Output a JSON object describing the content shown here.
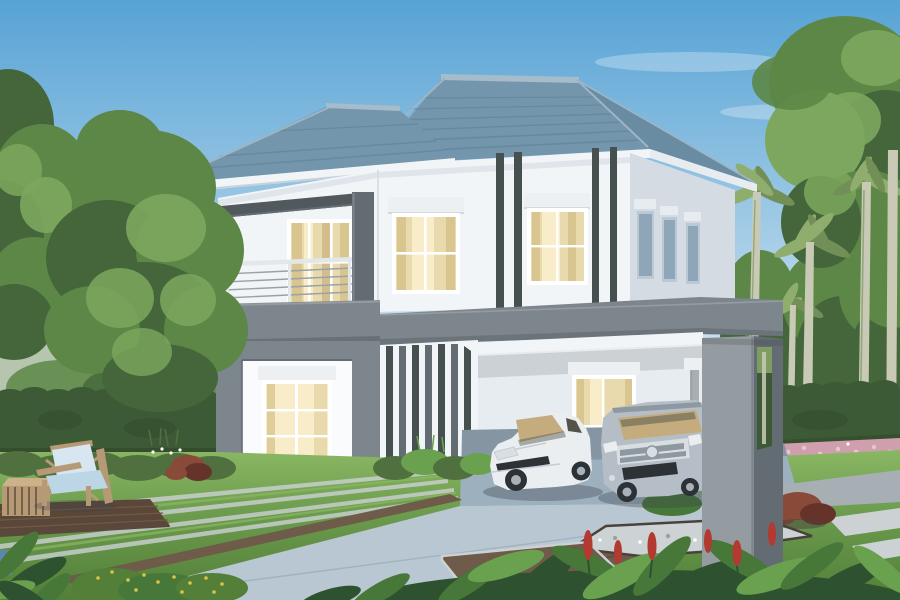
{
  "scene": {
    "type": "architectural exterior rendering",
    "description": "Modern two-storey detached house with slate-blue tiled hip roof, white walls with dark grey accent bands and charcoal pin-stripes, first-floor balcony with steel railing, warm-lit curtained windows, grey portal-frame carport sheltering a white sedan and a silver SUV, clipped hedges, palm trees, striped lawn, blue-grey paver driveway, timber deck with blue-cushioned armchair, white gravel bed and red-leaf shrubs",
    "objects": [
      "house",
      "hip-roof",
      "balcony",
      "carport",
      "white-sedan",
      "silver-suv",
      "outdoor-chair",
      "side-table",
      "timber-deck",
      "hedge-walls",
      "palm-trees",
      "garden-trees",
      "paver-driveway",
      "gravel-bed",
      "flower-beds",
      "foreground-plants"
    ]
  },
  "colors": {
    "sky-top": "#57a3d5",
    "sky-mid": "#a9cfe8",
    "sky-horizon": "#e9f1f4",
    "cloud": "#ffffff",
    "roof-tile": "#7496ac",
    "roof-tile-dark": "#5d7f95",
    "roof-tile-light": "#9db5c5",
    "roof-hip": "#698ca2",
    "roof-ridge": "#a6bcca",
    "fascia": "#f2f5f7",
    "soffit": "#c9d2d8",
    "wall-white": "#f2f5f8",
    "wall-bright": "#fafbfc",
    "wall-shadow": "#d4dbe3",
    "wall-tint": "#e7ecf0",
    "accent": "#7e868d",
    "accent-light": "#949ba1",
    "accent-dark": "#646c73",
    "accent-darker": "#51585e",
    "stripe": "#46504e",
    "frame-white": "#ffffff",
    "roller": "#edf0f2",
    "glass-warm": "#e9daae",
    "glass-bright": "#f8edc8",
    "curtain": "#d8c58f",
    "glass-amber": "#c8ad7a",
    "glass-cool": "#8ea6b8",
    "glass-cool-light": "#bac9d5",
    "railing": "#e2e7eb",
    "railing-dark": "#98a2aa",
    "hedge": "#3d5a36",
    "hedge-light": "#51703f",
    "hedge-dark": "#2e4527",
    "lawn": "#6a9a4c",
    "lawn-light": "#8ab763",
    "lawn-dark": "#537f39",
    "tree": "#5c8746",
    "tree-dark": "#44663a",
    "tree-light": "#7da75e",
    "tree-pale": "#b5c5ae",
    "palm": "#8fae6e",
    "palm-dark": "#728f58",
    "palm-trunk": "#c8cab5",
    "drive-light": "#b9c7d2",
    "drive-mid": "#9db0be",
    "concrete": "#a8afb4",
    "concrete-light": "#ccd1d4",
    "brown": "#6e5b4a",
    "brown-dark": "#59483b",
    "deck": "#5b4738",
    "deck-light": "#71594a",
    "wood": "#b69a75",
    "wood-light": "#cdb18a",
    "cushion": "#bdd6e6",
    "cushion-light": "#d7e6f0",
    "car-white": "#eaeef1",
    "car-white-sh": "#c5ced5",
    "silver": "#b5bec6",
    "silver-dark": "#8d98a0",
    "chrome": "#d9dee2",
    "tire": "#2d3237",
    "rim": "#a9b2b9",
    "tint": "#c4ac7f",
    "glass-dark": "#53534a",
    "red-shrub": "#8a4a3a",
    "red-dark": "#66332a",
    "pink": "#cf9fae",
    "pink-light": "#e7c6cf",
    "gravel": "#cdd2d4",
    "gravel-dark": "#999fa2",
    "soil": "#49413a",
    "spike": "#b23a30",
    "yellow": "#d9c44c",
    "shadow": "#39424a",
    "pot-blue": "#5e86ad",
    "plant-deep": "#2e5230",
    "plant-mid": "#477739",
    "plant-light": "#6aa14f"
  }
}
